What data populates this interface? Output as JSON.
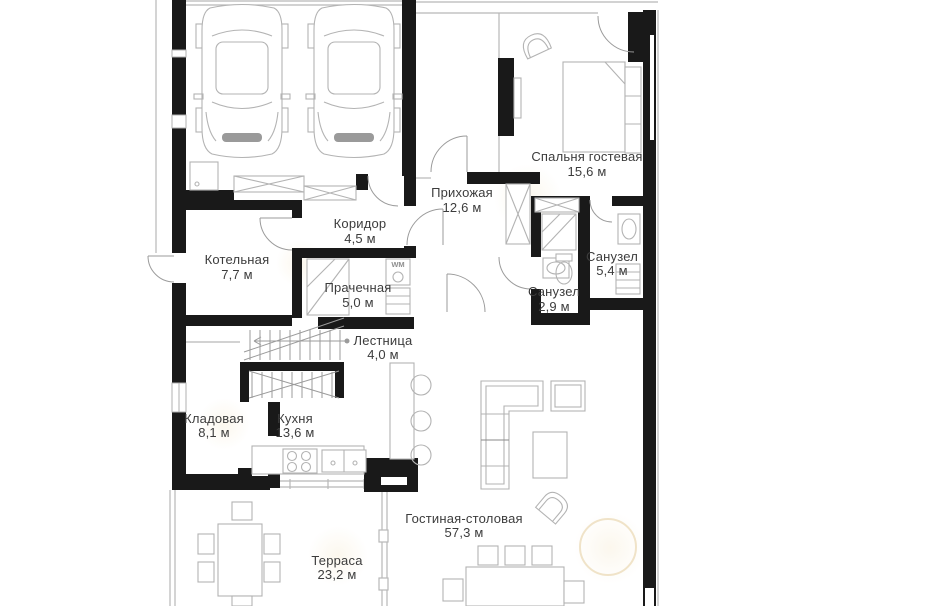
{
  "page": {
    "background": "#ffffff",
    "kind": "floor-plan",
    "language": "ru"
  },
  "plan": {
    "colors": {
      "wall": "#191919",
      "thin_line": "#b8b8b8",
      "furniture_line": "#b3b3b3",
      "label_text": "#3c3c3c",
      "glow_accent": "#f6ead0"
    },
    "rooms": [
      {
        "id": "guest-bedroom",
        "name": "Спальня гостевая",
        "area": "15,6 м"
      },
      {
        "id": "entry-hall",
        "name": "Прихожая",
        "area": "12,6 м"
      },
      {
        "id": "corridor",
        "name": "Коридор",
        "area": "4,5 м"
      },
      {
        "id": "boiler-room",
        "name": "Котельная",
        "area": "7,7 м"
      },
      {
        "id": "laundry",
        "name": "Прачечная",
        "area": "5,0 м"
      },
      {
        "id": "bathroom-1",
        "name": "Санузел",
        "area": "5,4 м"
      },
      {
        "id": "bathroom-2",
        "name": "Санузел",
        "area": "2,9 м"
      },
      {
        "id": "staircase",
        "name": "Лестница",
        "area": "4,0 м"
      },
      {
        "id": "storage",
        "name": "Кладовая",
        "area": "8,1 м"
      },
      {
        "id": "kitchen",
        "name": "Кухня",
        "area": "13,6 м"
      },
      {
        "id": "living-dining",
        "name": "Гостиная-столовая",
        "area": "57,3 м"
      },
      {
        "id": "terrace",
        "name": "Терраса",
        "area": "23,2 м"
      }
    ],
    "appliance_labels": {
      "washing_machine": "WM"
    }
  }
}
